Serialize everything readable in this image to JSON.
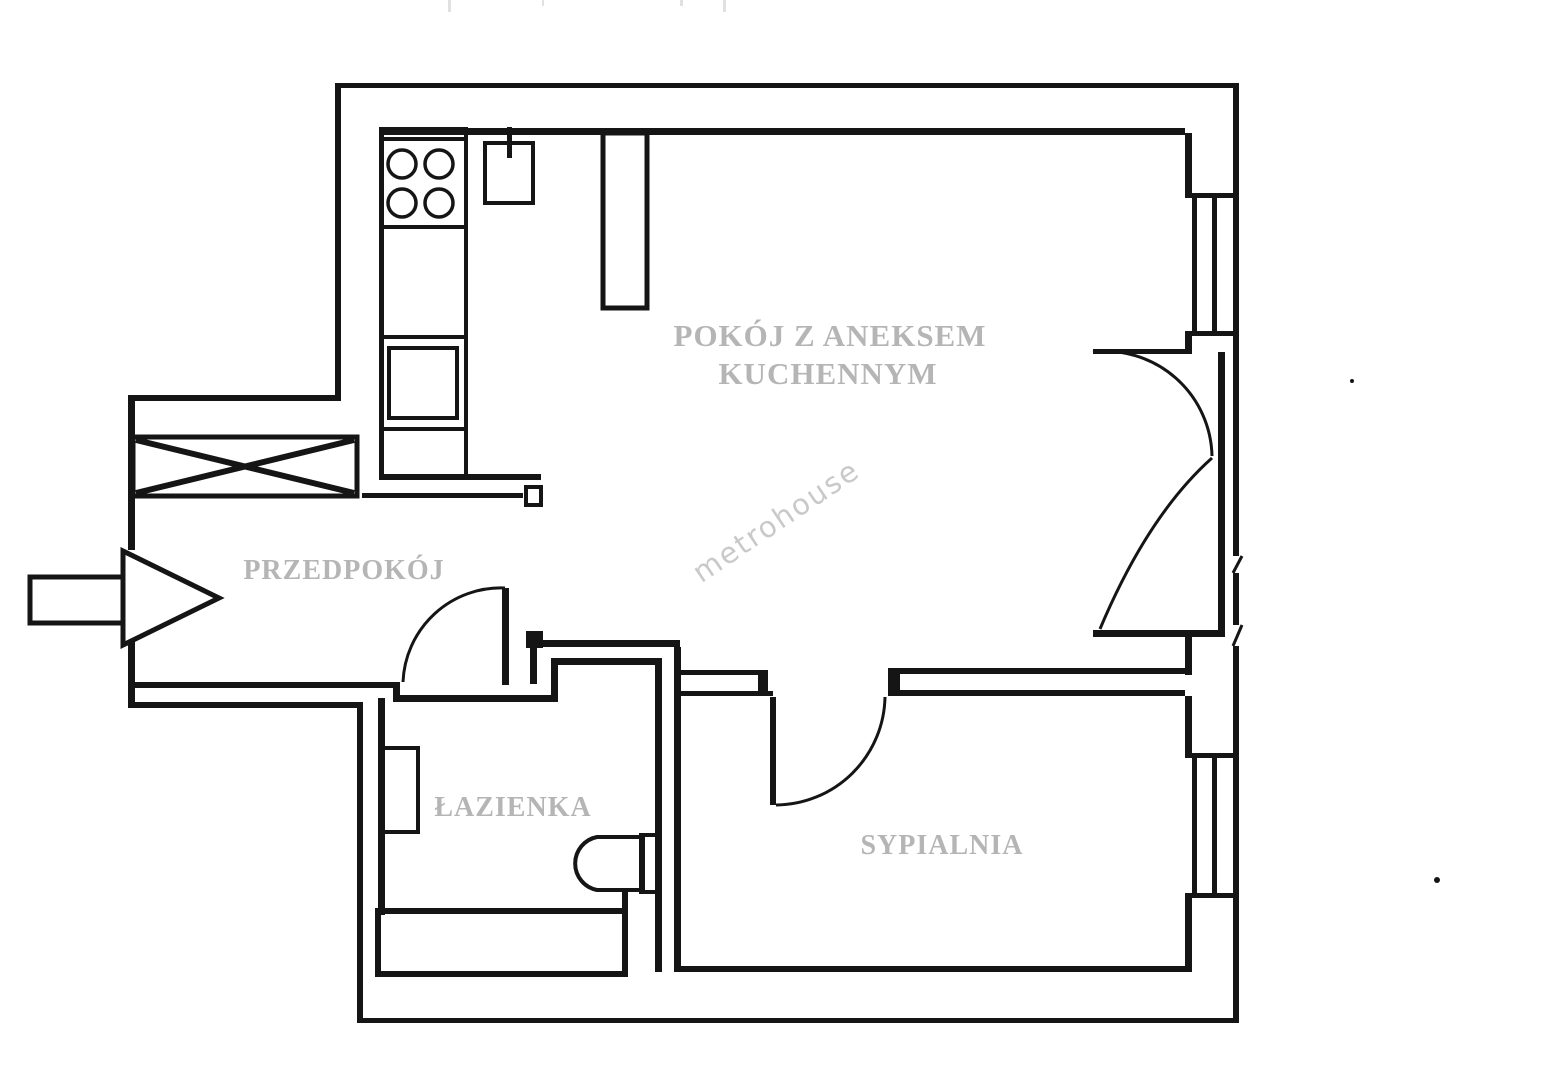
{
  "title": "apartment-floor-plan",
  "colors": {
    "line": "#151515",
    "room-label": "#b5b5b5",
    "watermark": "#c9c9c9",
    "bg": "#ffffff"
  },
  "labels": {
    "living_line1": "POKÓJ Z ANEKSEM",
    "living_line2": "KUCHENNYM",
    "hallway": "PRZEDPOKÓJ",
    "bathroom": "ŁAZIENKA",
    "bedroom": "SYPIALNIA"
  },
  "watermark": {
    "text": "metrohouse"
  },
  "fixtures": [
    "stove-4-burners",
    "kitchen-sink-with-tap",
    "fridge",
    "kitchen-counter",
    "built-in-wardrobe",
    "entrance-arrow",
    "washbasin",
    "toilet",
    "bathtub",
    "window-living-room",
    "window-bedroom",
    "balcony-double-door",
    "bathroom-door",
    "bedroom-door"
  ]
}
